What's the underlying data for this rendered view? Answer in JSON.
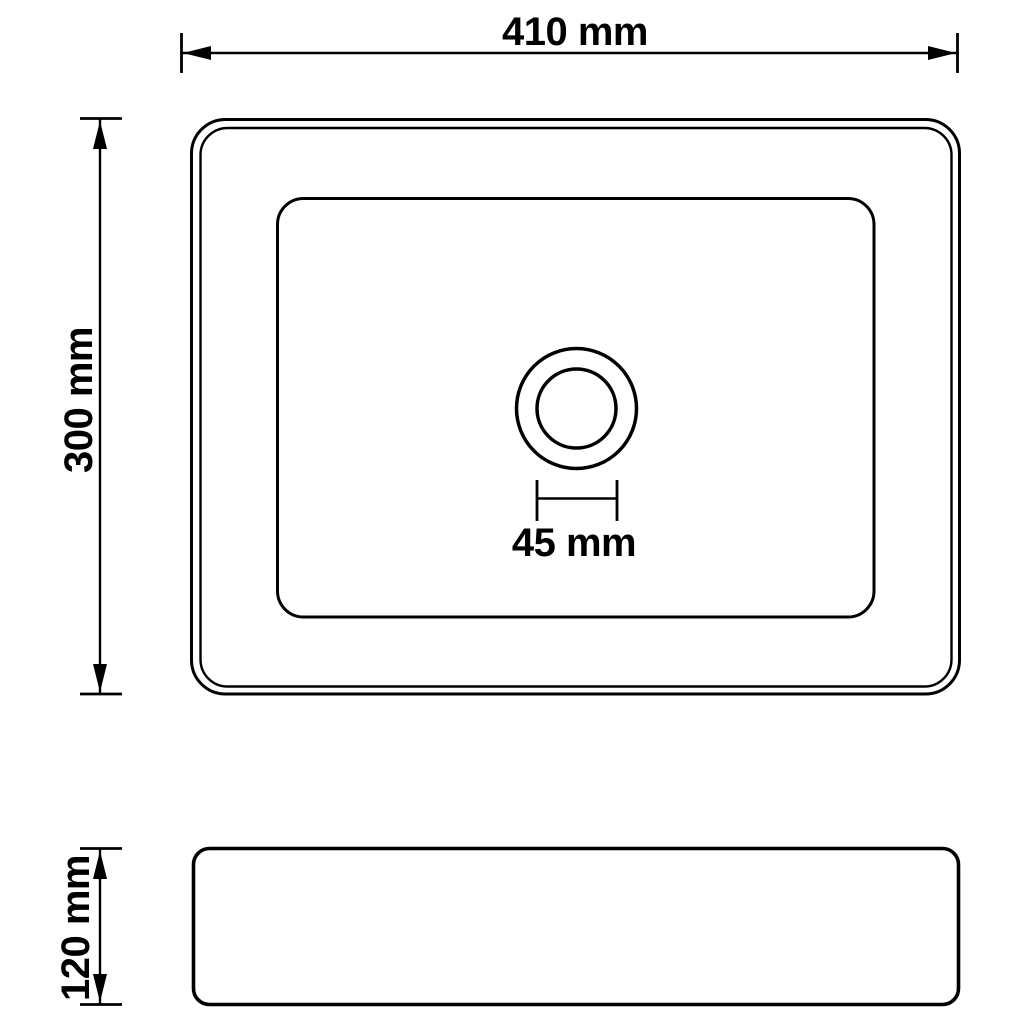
{
  "colors": {
    "line": "#000000",
    "text": "#000000",
    "background": "#ffffff"
  },
  "dimensions": {
    "width": {
      "label": "410 mm",
      "value_mm": 410
    },
    "depth": {
      "label": "300 mm",
      "value_mm": 300
    },
    "drain": {
      "label": "45 mm",
      "value_mm": 45
    },
    "height": {
      "label": "120 mm",
      "value_mm": 120
    }
  }
}
